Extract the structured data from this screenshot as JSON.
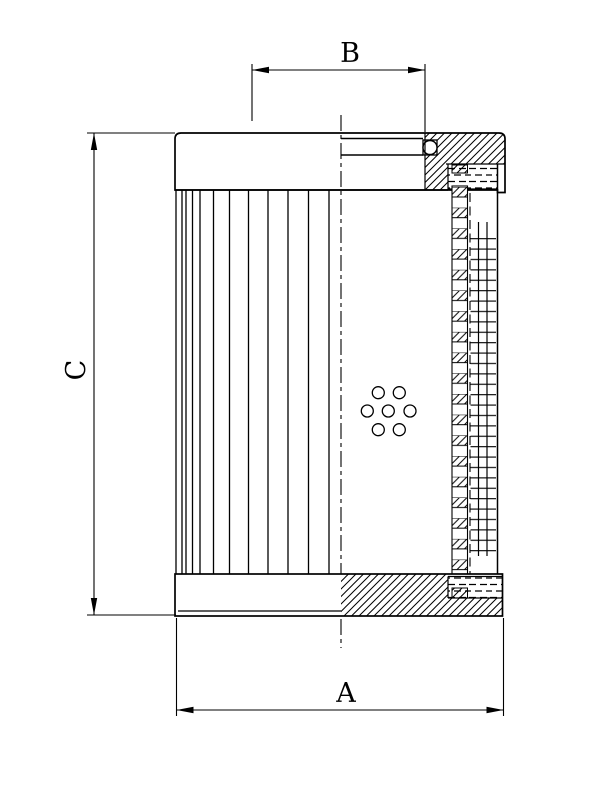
{
  "figure": {
    "kind": "technical line drawing",
    "subject": "filter element cross-section",
    "background_color": "#ffffff",
    "line_color": "#000000"
  },
  "dimension_labels": {
    "outer_diameter": "A",
    "bore_diameter": "B",
    "element_height": "C"
  }
}
